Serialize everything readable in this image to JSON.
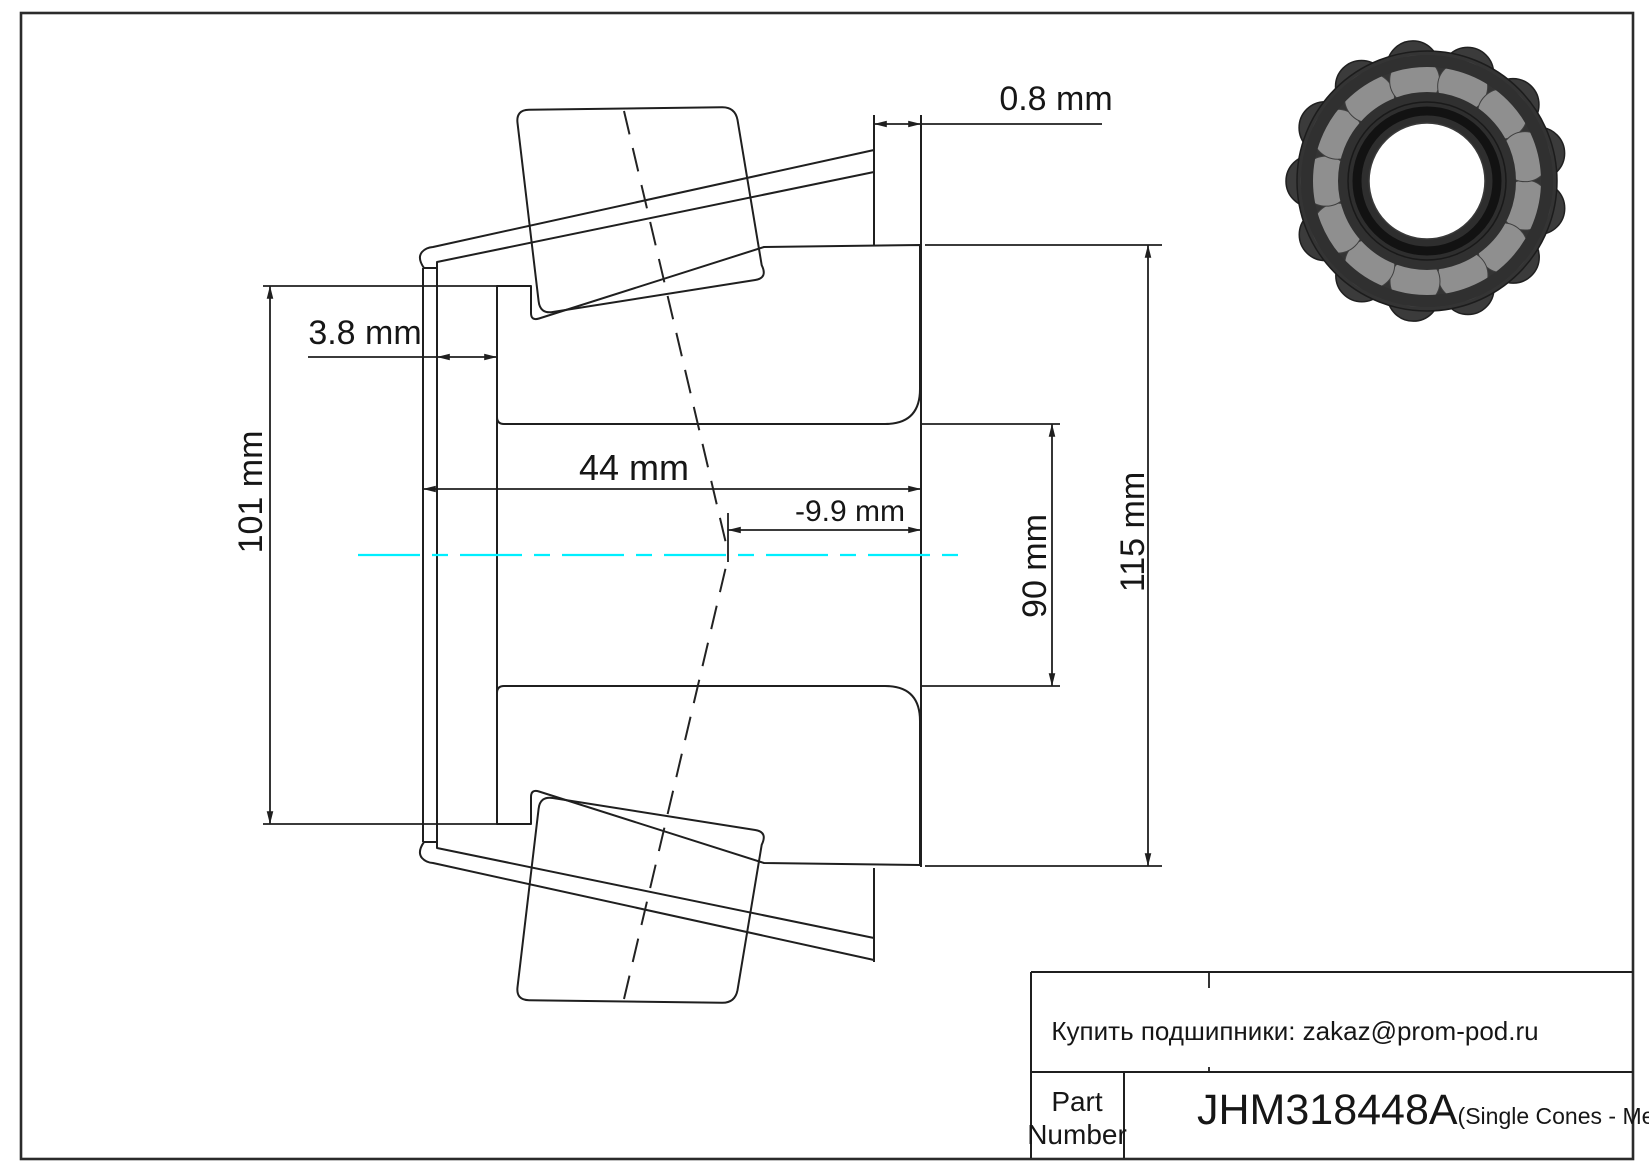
{
  "dimensions": {
    "backface_offset": "0.8 mm",
    "front_protrusion": "3.8 mm",
    "small_outer_diameter": "101 mm",
    "cone_width": "44 mm",
    "effective_center": "-9.9 mm",
    "bore_diameter": "90 mm",
    "large_outer_diameter": "115 mm"
  },
  "title_block": {
    "contact": "Купить подшипники: zakaz@prom-pod.ru",
    "part_label_line1": "Part",
    "part_label_line2": "Number",
    "part_number": "JHM318448A",
    "part_series": "(Single Cones - Metric)"
  },
  "colors": {
    "centerline": "#00efff",
    "line": "#1f1f1f"
  }
}
